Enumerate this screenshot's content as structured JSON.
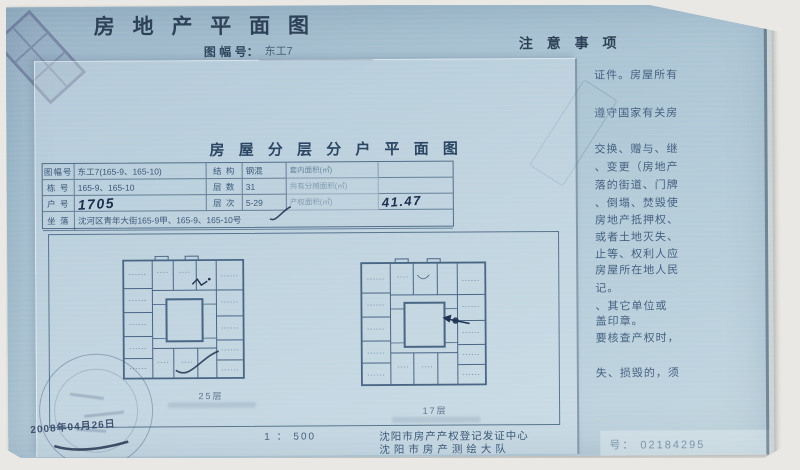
{
  "header": {
    "title": "房 地 产 平 面 图",
    "sheet_no_label": "图 幅 号：",
    "sheet_no_value": "东工7",
    "notice_title": "注 意 事 项"
  },
  "notice_lines": [
    "证件。房屋所有",
    "遵守国家有关房",
    "交换、赠与、继",
    "、变更（房地产",
    "落的街道、门牌",
    "、倒塌、焚毁使",
    "房地产抵押权、",
    "或者土地灭失、",
    "止等、权利人应",
    "房屋所在地人民",
    "记。",
    "、其它单位或",
    "盖印章。",
    "要核查产权时，",
    "失、损毁的，须"
  ],
  "plan_sheet": {
    "subtitle": "房 屋 分 层 分 户 平 面 图",
    "table": {
      "rows": [
        {
          "c1": "图幅号",
          "c2": "东工7(165-9、165-10)",
          "c3": "结 构",
          "c4": "钢混",
          "c5": "套内面积(㎡)",
          "c6": ""
        },
        {
          "c1": "栋 号",
          "c2": "165-9、165-10",
          "c3": "层 数",
          "c4": "31",
          "c5": "共有分摊面积(㎡)",
          "c6": ""
        },
        {
          "c1": "户 号",
          "c2": "1705",
          "c3": "层 次",
          "c4": "5-29",
          "c5": "产权面积(㎡)",
          "c6": "41.47"
        },
        {
          "c1": "坐 落",
          "c2": "沈河区青年大街165-9甲、165-9、165-10号"
        }
      ]
    },
    "plans": [
      {
        "caption": "25层"
      },
      {
        "caption": "17层"
      }
    ],
    "scale": "1 ： 500",
    "issuer_line1": "沈阳市房产产权登记发证中心",
    "issuer_line2": "沈阳市房产测绘大队",
    "date_note": "2008年04月26日",
    "serial": "号： 02184295"
  }
}
